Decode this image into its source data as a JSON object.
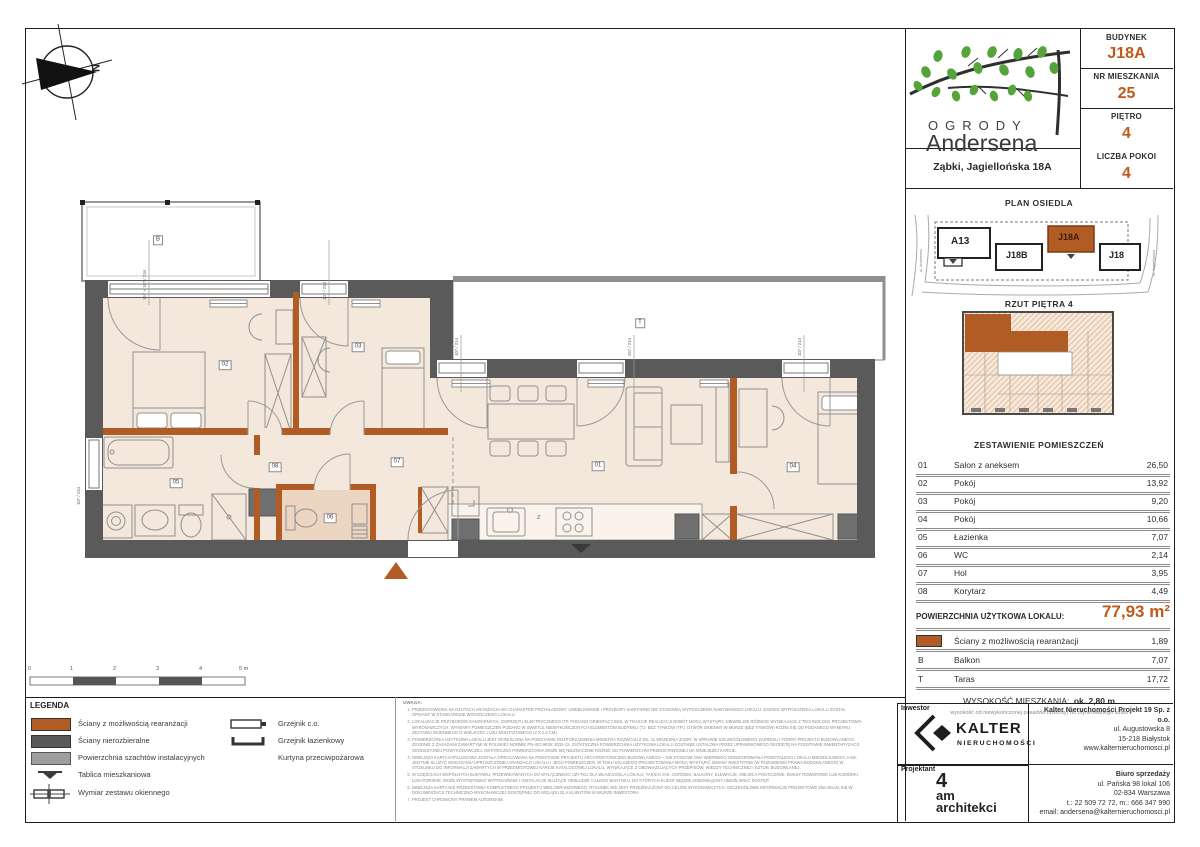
{
  "colors": {
    "accent": "#c05a1a",
    "wall_orange": "#b05c24",
    "wall_dark": "#5a5a5a",
    "shaft_gray": "#9e9e9e",
    "room_fill": "#f4e7dc"
  },
  "logo": {
    "line1": "OGRODY",
    "line2": "Andersena"
  },
  "header": {
    "address": "Ząbki, Jagiellońska 18A",
    "fields": [
      {
        "label": "BUDYNEK",
        "value": "J18A"
      },
      {
        "label": "NR MIESZKANIA",
        "value": "25"
      },
      {
        "label": "PIĘTRO",
        "value": "4"
      },
      {
        "label": "LICZBA POKOI",
        "value": "4"
      }
    ]
  },
  "site": {
    "title": "PLAN OSIEDLA",
    "streets": {
      "left": "ul. Andersena",
      "right": "ul. Jagiellońska"
    },
    "buildings": [
      "A13",
      "J18B",
      "J18A",
      "J18"
    ]
  },
  "floor_overview": {
    "title": "RZUT PIĘTRA 4"
  },
  "rooms": {
    "title": "ZESTAWIENIE POMIESZCZEŃ",
    "rows": [
      {
        "no": "01",
        "name": "Salon z aneksem",
        "area": "26,50"
      },
      {
        "no": "02",
        "name": "Pokój",
        "area": "13,92"
      },
      {
        "no": "03",
        "name": "Pokój",
        "area": "9,20"
      },
      {
        "no": "04",
        "name": "Pokój",
        "area": "10,66"
      },
      {
        "no": "05",
        "name": "Łazienka",
        "area": "7,07"
      },
      {
        "no": "06",
        "name": "WC",
        "area": "2,14"
      },
      {
        "no": "07",
        "name": "Hol",
        "area": "3,95"
      },
      {
        "no": "08",
        "name": "Korytarz",
        "area": "4,49"
      }
    ]
  },
  "summary": {
    "label": "POWIERZCHNIA UŻYTKOWA LOKALU:",
    "value": "77,93 m²",
    "extras": [
      {
        "code": "",
        "name": "Ściany z możliwością rearanżacji",
        "area": "1,89"
      },
      {
        "code": "B",
        "name": "Balkon",
        "area": "7,07"
      },
      {
        "code": "T",
        "name": "Taras",
        "area": "17,72"
      }
    ]
  },
  "height": {
    "label": "WYSOKOŚĆ MIESZKANIA:",
    "value": "ok. 2,80 m",
    "sub": "wysokość od niewykończonej posadzki (szlichty) do otynkowanego sufitu"
  },
  "legend": {
    "title": "LEGENDA",
    "left": [
      "Ściany z możliwością rearanżacji",
      "Ściany nierozbieralne",
      "Powierzchnia szachtów instalacyjnych",
      "Tablica mieszkaniowa",
      "Wymiar zestawu okiennego"
    ],
    "right": [
      "Grzejnik c.o.",
      "Grzejnik łazienkowy",
      "Kurtyna przeciwpożarowa"
    ]
  },
  "notes": {
    "title": "UWAGA:",
    "items": [
      "PRZEDSTAWIONA NA RZUTACH ARANŻACJA MA CHARAKTER PRZYKŁADOWY. UMEBLOWANIE I PRZYBORY SANITARNE NIE STANOWIĄ WYPOSAŻENIA NABYWANEGO LOKALU. ZAKRES WYPOSAŻENIA LOKALU ZOSTAŁ OPISANY W STANDARDZIE WYKOŃCZENIA LOKALU.",
      "LOKALIZACJE PRZYBORÓW SANITARNYCH, OSPRZĘTU ELEKTRYCZNEGO ITP. PODANO ORIENTACYJNIE. W TRAKCIE REALIZACJI ROBÓT MOGĄ WYSTĄPIĆ NIEWIELKIE RÓŻNICE WYNIKAJĄCE Z TECHNOLOGII PROJEKTOWO-WYKONAWCZYCH. WYMIARY POMIESZCZEŃ PODANO W ŚWIETLE NIEWYKOŃCZONYCH ELEMENTÓW BUDYNKU (TJ. BEZ TYNKÓW ITP.). OTWÓR OKIENNY W MURZE (BEZ TYNKÓW) RÓŻNI SIĘ OD PODANEGO WYMIARU ZESTAWU OKIENNEGO O WIELKOŚĆ LUZU MONTAŻOWEGO (2 X 1,5 CM).",
      "POWIERZCHNIA UŻYTKOWA LOKALU JEST OKREŚLONA NA PODSTAWIE ROZPORZĄDZENIA MINISTRA ROZWOJU Z DN. 11 WRZEŚNIA 2020R. W SPRAWIE SZCZEGÓŁOWEGO ZAKRESU I FORMY PROJEKTU BUDOWLANEGO, ZGODNIE Z ZASADAMI ZAWARTYMI W POLSKIEJ NORMIE PN-ISO 9836: 2015-12. OSTATECZNA POWIERZCHNIA UŻYTKOWA LOKALU ZOSTANIE USTALONA PRZEZ UPRAWNIONEGO GEODETĘ NA PODSTAWIE INWENTARYZACJI GEODEZYJNEJ POWYKONAWCZEJ. OSTATECZNA POWIERZCHNIA MOŻE SIĘ NIEZNACZNIE RÓŻNIĆ OD POWIERZCHNI PRZEDSTAWIONEJ NA NINIEJSZEJ KARCIE.",
      "NINIEJSZA KARTA KATALOGOWA ZOSTAŁA OPRACOWANA NA PODSTAWIE PROJEKTU ARCHITEKTONICZNO-BUDOWLANEGO – NIE STANOWI ONA WIERNEGO ODWZOROWANIA POWSTAŁEGO LOKALU MIESZKALNEGO, A MA JEDYNIE SŁUŻYĆ WSKAZANIU UPROSZCZONEJ ARANŻACJI LOKALU I JEGO POMIESZCZEŃ. W TOKU DALSZEGO PROJEKTOWANIA MOGĄ WYSTĄPIĆ ZMIANY NIEISTOTNE (W ROZUMIENIU PRAWA BUDOWLANEGO) W STOSUNKU DO INFORMACJI ZAWARTYCH W PRZEDMIOTOWEJ KARCIE KATALOGOWEJ LOKALU, WYNIKAJĄCE Z OBOWIĄZUJĄCYCH PRZEPISÓW, WIEDZY TECHNICZNEJ I SZTUKI BUDOWLANEJ.",
      "W CZĘŚCIACH WSPÓLNYCH BUDYNKU, PRZEWIDYWANYCH DO WYŁĄCZNEGO UŻYTKU DLA WŁAŚCICIELA LOKALU, TAKICH JAK: OGRÓDKI, BALKONY, ELEWACJE, MIEJSCA POSTOJOWE, BOKSY ROWEROWE LUB KOMÓRKI LOKATORSKIE, MOŻE WYSTĘPOWAĆ WYPOSAŻENIE I INSTALACJE SŁUŻĄCE OBSŁUDZE CAŁEGO BUDYNKU, DO KTÓRYCH KLIENT BĘDZIE ZOBOWIĄZANY UMOŻLIWIAĆ DOSTĘP.",
      "NINIEJSZA KARTA NIE PRZEDSTAWIA KOMPLETNEGO PROJEKTU WIELOBRANŻOWEGO. RYSUNEK NIE JEST PRZEZNACZONY DO CELÓW WYKONAWCZYCH. SZCZEGÓŁOWE INFORMACJE PROJEKTOWE ZNAJDUJĄ SIĘ W DOKUMENTACJI TECHNICZNO-WYKONAWCZEJ DOSTĘPNEJ DO WGLĄDU DLA KLIENTÓW W BIURZE INWESTORA.",
      "PROJEKT CHRONIONY PRAWEM AUTORSKIM."
    ]
  },
  "footer": {
    "investor_label": "Inwestor",
    "kalter": {
      "name": "KALTER",
      "sub": "nieruchomości"
    },
    "designer_label": "Projektant",
    "designer": {
      "l1": "4",
      "l2": "am",
      "l3": "architekci"
    },
    "company": {
      "name": "Kalter Nieruchomości Projekt 19 Sp. z o.o.",
      "l1": "ul. Augustowska 8",
      "l2": "15-218 Białystok",
      "l3": "www.kalternieruchomosci.pl"
    },
    "sales": {
      "title": "Biuro sprzedaży",
      "l1": "ul. Pańska 98 lokal 106",
      "l2": "02-834 Warszawa",
      "l3": "t.: 22 509 72 72, m.: 666 347 990",
      "l4": "email: andersena@kalternieruchomosci.pl"
    }
  },
  "plan": {
    "room_labels": [
      "01",
      "02",
      "03",
      "04",
      "05",
      "06",
      "07",
      "08",
      "B",
      "T"
    ],
    "dims": [
      "157 + 167 / 234",
      "107 / 234",
      "107 / 214",
      "257 / 214",
      "107 / 214",
      "107 / 234"
    ],
    "north": "N",
    "scale": [
      "0",
      "1",
      "2",
      "3",
      "4",
      "5 m"
    ],
    "kitchen_sink": "Z"
  }
}
